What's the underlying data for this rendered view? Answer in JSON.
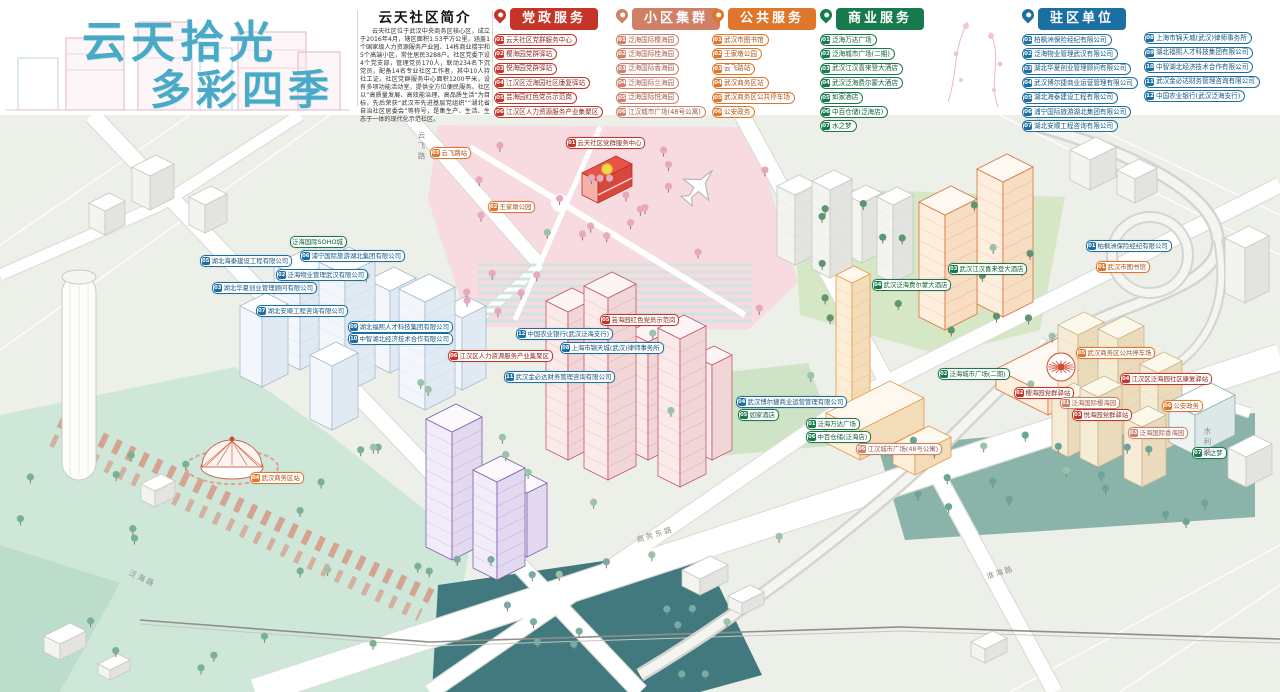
{
  "logo": {
    "line1": "云天拾光",
    "line2": "多彩四季"
  },
  "intro": {
    "title": "云天社区简介",
    "body": "云天社区位于武汉中央商务区核心区，成立于2016年4月，辖区面积1.53平方公里，涵盖1个国家级人力资源服务产业园、14栋商业楼宇和5个高端小区，常住居民3288户。社区党委下设4个党支部，管理党员170人，联动234名下沉党员，配备14名专业社区工作者，其中10人持社工证。社区党群服务中心面积1200平米，设有多项功能活动室，提供全方位便民服务。社区以“高质量发展、高效能治理、高品质生活”为目标，先后荣获“武汉市先进基层党组织”“湖北省自治社区居委会”等称号，是集生产、生活、生态于一体的现代化示范社区。"
  },
  "legend": [
    {
      "id": "party-services",
      "title": "党政服务",
      "color": "#c43527",
      "text": "#8a2a20",
      "items": [
        {
          "num": "01",
          "label": "云天社区党群服务中心"
        },
        {
          "num": "02",
          "label": "樱海园党群驿站"
        },
        {
          "num": "03",
          "label": "悦海园党群驿站"
        },
        {
          "num": "04",
          "label": "江汉区泛海园社区康复驿站"
        },
        {
          "num": "05",
          "label": "芸海园红色党员示范岗"
        },
        {
          "num": "06",
          "label": "江汉区人力资源服务产业集聚区"
        }
      ]
    },
    {
      "id": "residential-clusters",
      "title": "小区集群",
      "color": "#cf8066",
      "text": "#a05a45",
      "items": [
        {
          "num": "01",
          "label": "泛海国际樱海园"
        },
        {
          "num": "02",
          "label": "泛海国际桂海园"
        },
        {
          "num": "03",
          "label": "泛海国际香海园"
        },
        {
          "num": "04",
          "label": "泛海国际兰海园"
        },
        {
          "num": "05",
          "label": "泛海国际悦海园"
        },
        {
          "num": "06",
          "label": "江汉城市广场(48号公寓)"
        }
      ]
    },
    {
      "id": "public-services",
      "title": "公共服务",
      "color": "#e0762c",
      "text": "#a85317",
      "items": [
        {
          "num": "01",
          "label": "武汉市图书馆"
        },
        {
          "num": "02",
          "label": "王家墩公园"
        },
        {
          "num": "03",
          "label": "云飞路站"
        },
        {
          "num": "04",
          "label": "武汉商务区站"
        },
        {
          "num": "05",
          "label": "武汉商务区公共停车场"
        },
        {
          "num": "06",
          "label": "公安政务"
        }
      ]
    },
    {
      "id": "business-services",
      "title": "商业服务",
      "color": "#177a4b",
      "text": "#135e3b",
      "items": [
        {
          "num": "01",
          "label": "泛海万达广场"
        },
        {
          "num": "02",
          "label": "泛海城市广场(二期)"
        },
        {
          "num": "03",
          "label": "武汉江汉喜来登大酒店"
        },
        {
          "num": "04",
          "label": "武汉泛海费尔蒙大酒店"
        },
        {
          "num": "05",
          "label": "如家酒店"
        },
        {
          "num": "06",
          "label": "中百仓储(泛海店)"
        },
        {
          "num": "07",
          "label": "水之梦"
        }
      ]
    },
    {
      "id": "resident-units",
      "title": "驻区单位",
      "color": "#1c6fa3",
      "text": "#17567e",
      "items": [
        {
          "num": "01",
          "label": "柏枫洲保险经纪有限公司"
        },
        {
          "num": "02",
          "label": "泛海物业管理武汉有限公司"
        },
        {
          "num": "03",
          "label": "湖北华夏创业管理顾问有限公司"
        },
        {
          "num": "04",
          "label": "武汉博尔捷商业运营管理有限公司"
        },
        {
          "num": "05",
          "label": "湖北海泰建设工程有限公司"
        },
        {
          "num": "06",
          "label": "浦宁国际旅游湖北集团有限公司"
        },
        {
          "num": "07",
          "label": "湖北安顺工程咨询有限公司"
        }
      ],
      "items2": [
        {
          "num": "08",
          "label": "上海市锦天城(武汉)律师事务所"
        },
        {
          "num": "09",
          "label": "湖北福熙人才科技集团有限公司"
        },
        {
          "num": "10",
          "label": "中智湖北经济技术合作有限公司"
        },
        {
          "num": "11",
          "label": "武汉金必达财务管理咨询有限公司"
        },
        {
          "num": "12",
          "label": "中国农业银行(武汉泛海支行)"
        }
      ]
    }
  ],
  "map": {
    "road_names": [
      "云飞路",
      "商务东路",
      "淮海路",
      "泛海路",
      "水利路"
    ],
    "markers": [
      {
        "num": "01",
        "type": "party",
        "label": "云天社区党群服务中心",
        "x": 566,
        "y": 28
      },
      {
        "num": "05",
        "type": "party",
        "label": "芸海园红色党员示范岗",
        "x": 600,
        "y": 205
      },
      {
        "num": "06",
        "type": "party",
        "label": "江汉区人力资源服务产业集聚区",
        "x": 448,
        "y": 241
      },
      {
        "num": "02",
        "type": "party",
        "label": "樱海园党群驿站",
        "x": 1014,
        "y": 278
      },
      {
        "num": "03",
        "type": "party",
        "label": "悦海园党群驿站",
        "x": 1072,
        "y": 300
      },
      {
        "num": "04",
        "type": "party",
        "label": "江汉区泛海园社区康复驿站",
        "x": 1120,
        "y": 264
      },
      {
        "num": "01",
        "type": "cluster",
        "label": "泛海国际樱海园",
        "x": 1060,
        "y": 288
      },
      {
        "num": "03",
        "type": "cluster",
        "label": "泛海国际香海园",
        "x": 1128,
        "y": 318
      },
      {
        "num": "06",
        "type": "cluster",
        "label": "江汉城市广场(48号公寓)",
        "x": 856,
        "y": 334
      },
      {
        "num": "02",
        "type": "public",
        "label": "王家墩公园",
        "x": 488,
        "y": 92
      },
      {
        "num": "03",
        "type": "public",
        "label": "云飞路站",
        "x": 430,
        "y": 38
      },
      {
        "num": "04",
        "type": "public",
        "label": "武汉商务区站",
        "x": 250,
        "y": 363
      },
      {
        "num": "05",
        "type": "public",
        "label": "武汉商务区公共停车场",
        "x": 1076,
        "y": 238
      },
      {
        "num": "01",
        "type": "public",
        "label": "武汉市图书馆",
        "x": 1096,
        "y": 152
      },
      {
        "num": "06",
        "type": "public",
        "label": "公安政务",
        "x": 1162,
        "y": 291
      },
      {
        "num": "04",
        "type": "biz",
        "label": "武汉泛海费尔蒙大酒店",
        "x": 872,
        "y": 170
      },
      {
        "num": "03",
        "type": "biz",
        "label": "武汉江汉喜来登大酒店",
        "x": 948,
        "y": 154
      },
      {
        "num": "02",
        "type": "biz",
        "label": "泛海城市广场(二期)",
        "x": 938,
        "y": 259
      },
      {
        "num": "01",
        "type": "biz",
        "label": "泛海万达广场",
        "x": 806,
        "y": 309
      },
      {
        "num": "06",
        "type": "biz",
        "label": "中百仓储(泛海店)",
        "x": 806,
        "y": 322
      },
      {
        "num": "05",
        "type": "biz",
        "label": "如家酒店",
        "x": 738,
        "y": 300
      },
      {
        "num": "07",
        "type": "biz",
        "label": "水之梦",
        "x": 1192,
        "y": 338
      },
      {
        "num": "",
        "type": "biz",
        "label": "泛海国际SOHO城",
        "x": 290,
        "y": 127
      },
      {
        "num": "12",
        "type": "unit",
        "label": "中国农业银行(武汉泛海支行)",
        "x": 516,
        "y": 219
      },
      {
        "num": "08",
        "type": "unit",
        "label": "上海市锦天城(武汉)律师事务所",
        "x": 560,
        "y": 233
      },
      {
        "num": "11",
        "type": "unit",
        "label": "武汉金必达财务管理咨询有限公司",
        "x": 504,
        "y": 262
      },
      {
        "num": "05",
        "type": "unit",
        "label": "湖北海泰建设工程有限公司",
        "x": 200,
        "y": 146
      },
      {
        "num": "02",
        "type": "unit",
        "label": "泛海物业管理武汉有限公司",
        "x": 276,
        "y": 160
      },
      {
        "num": "03",
        "type": "unit",
        "label": "湖北华夏创业管理顾问有限公司",
        "x": 212,
        "y": 173
      },
      {
        "num": "07",
        "type": "unit",
        "label": "湖北安顺工程咨询有限公司",
        "x": 256,
        "y": 196
      },
      {
        "num": "09",
        "type": "unit",
        "label": "湖北福熙人才科技集团有限公司",
        "x": 348,
        "y": 212
      },
      {
        "num": "10",
        "type": "unit",
        "label": "中智湖北经济技术合作有限公司",
        "x": 348,
        "y": 224
      },
      {
        "num": "04",
        "type": "unit",
        "label": "武汉博尔捷商业运营管理有限公司",
        "x": 736,
        "y": 287
      },
      {
        "num": "01",
        "type": "unit",
        "label": "柏枫洲保险经纪有限公司",
        "x": 1086,
        "y": 131
      },
      {
        "num": "06",
        "type": "unit",
        "label": "浦宁国际旅游湖北集团有限公司",
        "x": 300,
        "y": 141
      }
    ]
  }
}
